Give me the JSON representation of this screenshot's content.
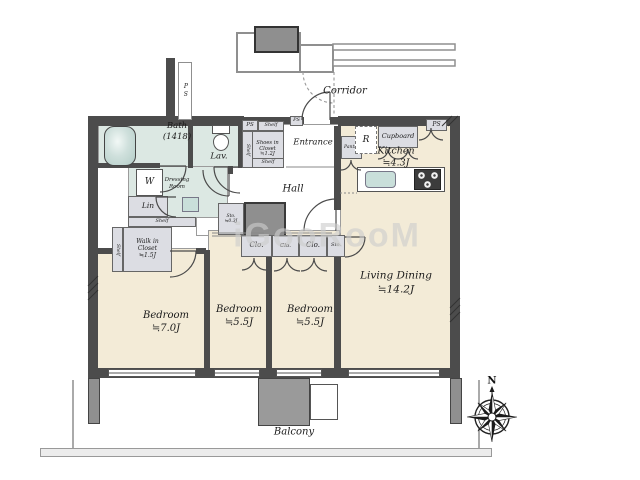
{
  "plan_title": "apartment-floor-plan",
  "watermark": "iGooRooM",
  "colors": {
    "floor": "#f3ebd7",
    "wet": "#dce8e3",
    "closet": "#dcdde3",
    "wall": "#4c4c4c",
    "shaft": "#8f8f8f",
    "sink": "#c9dfda",
    "watermark": "#cdcdcd"
  },
  "labels": {
    "corridor": "Corridor",
    "balcony": "Balcony",
    "north": "N",
    "hall": "Hall",
    "entrance": "Entrance",
    "bath": "Bath\n(1418)",
    "lav": "Lav.",
    "dressing_room": "Dressing\nRoom",
    "washer": "W",
    "linen": "Lin",
    "shelf": "Shelf",
    "walk_in_closet": "Walk in\nCloset\n≒1.5J",
    "shoes_in_closet": "Shoes in\nCloset\n≒1.2J",
    "ps": "PS",
    "pantry": "Pantry",
    "refrigerator": "R",
    "cupboard": "Cupboard",
    "kitchen": "Kitchen\n≒4.3J",
    "living_dining": "Living Dining\n≒14.2J",
    "bedroom_1": "Bedroom\n≒7.0J",
    "bedroom_2": "Bedroom\n≒5.5J",
    "bedroom_3": "Bedroom\n≒5.5J",
    "closet": "Clo.",
    "storage": "Sto.",
    "storage_small": "Sto.\n≒0.3J"
  }
}
